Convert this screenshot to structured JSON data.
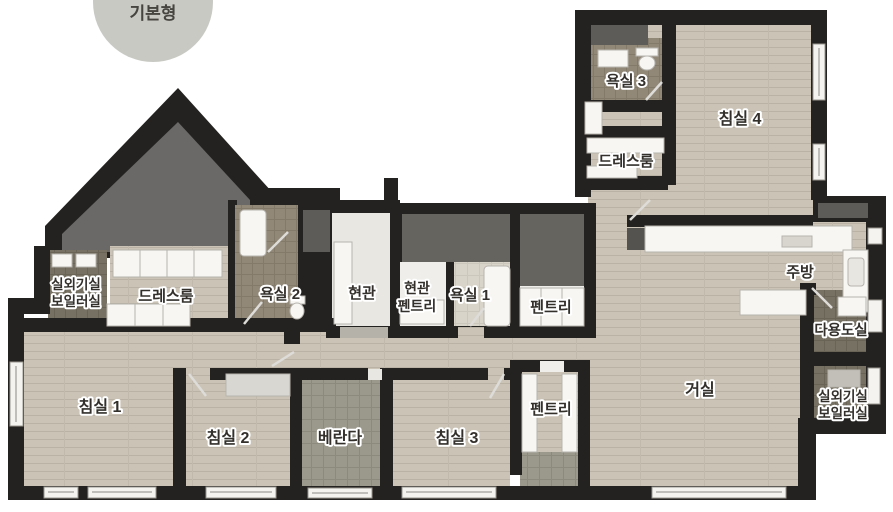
{
  "badge": {
    "label": "기본형"
  },
  "palette": {
    "wall": "#242220",
    "wood_floor": "#cbc4b6",
    "plank_line": "#b9b1a3",
    "veranda_tile": "#9b988c",
    "bath_tile": "#8f8676",
    "utility_tile": "#767163",
    "void_gray": "#66645f",
    "fixture_white": "#f7f6f3",
    "badge_bg": "#c9c9c4"
  },
  "rooms": {
    "outdoor_boiler_left": {
      "line1": "실외기실",
      "line2": "보일러실"
    },
    "dressroom_left": {
      "label": "드레스룸"
    },
    "bath2": {
      "label": "욕실 2"
    },
    "entrance": {
      "label": "현관"
    },
    "entrance_pantry": {
      "line1": "현관",
      "line2": "펜트리"
    },
    "bath1": {
      "label": "욕실 1"
    },
    "pantry_top": {
      "label": "펜트리"
    },
    "bath3": {
      "label": "욕실 3"
    },
    "bedroom4": {
      "label": "침실 4"
    },
    "dressroom_right": {
      "label": "드레스룸"
    },
    "kitchen": {
      "label": "주방"
    },
    "utility": {
      "label": "다용도실"
    },
    "outdoor_boiler_right": {
      "line1": "실외기실",
      "line2": "보일러실"
    },
    "bedroom1": {
      "label": "침실 1"
    },
    "bedroom2": {
      "label": "침실 2"
    },
    "veranda": {
      "label": "베란다"
    },
    "bedroom3": {
      "label": "침실 3"
    },
    "pantry_bottom": {
      "label": "펜트리"
    },
    "living": {
      "label": "거실"
    }
  }
}
